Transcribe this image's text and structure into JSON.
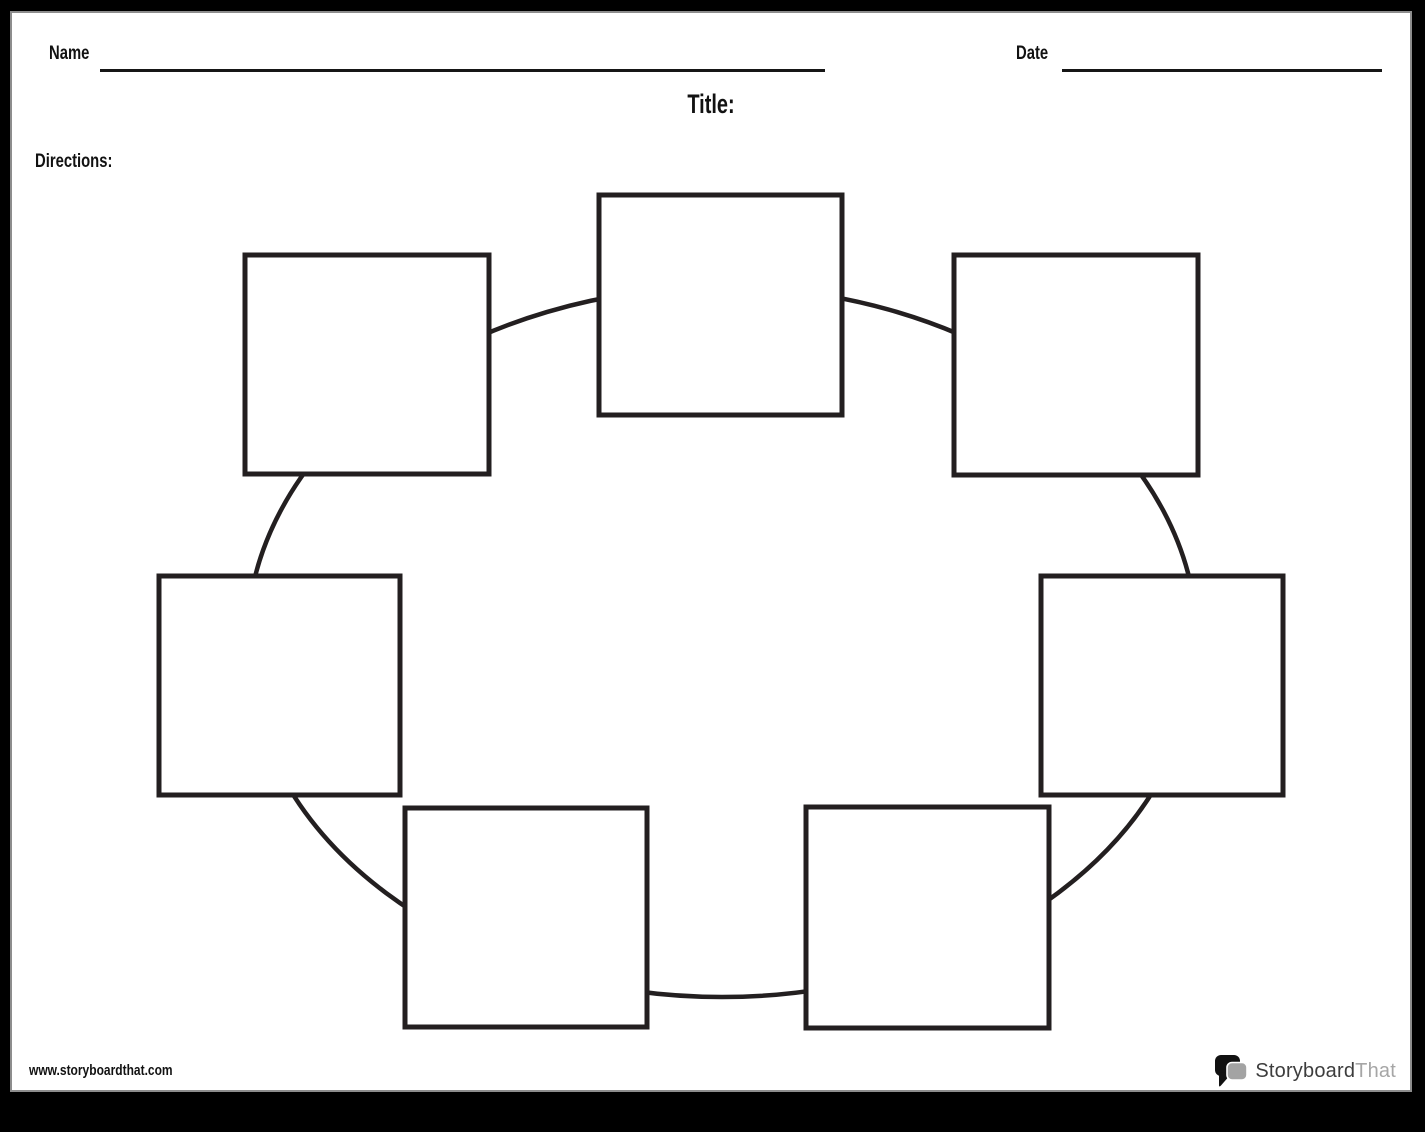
{
  "page": {
    "background": "#ffffff",
    "canvas_background": "#000000",
    "edge_color": "#8d8d8d"
  },
  "header": {
    "name_label": "Name",
    "date_label": "Date",
    "title_label": "Title:",
    "directions_label": "Directions:"
  },
  "footer": {
    "website": "www.storyboardthat.com",
    "logo": {
      "brand_primary": "Storyboard",
      "brand_secondary": "That",
      "primary_color": "#3d3d3d",
      "secondary_color": "#a6a6a6",
      "icon": "speech-bubbles-icon",
      "icon_black": "#111111",
      "icon_gray": "#a3a3a3"
    }
  },
  "diagram": {
    "type": "circle-chart",
    "cell_count": 7,
    "cells_empty": true,
    "stroke_color": "#231f20",
    "fill_color": "#ffffff",
    "ellipse": {
      "cx": 710,
      "cy": 629,
      "rx": 475,
      "ry": 355,
      "stroke_width": 4.5
    },
    "cell_stroke_width": 5,
    "cells": [
      {
        "id": "top",
        "x": 587,
        "y": 182,
        "w": 243,
        "h": 220
      },
      {
        "id": "top-right",
        "x": 942,
        "y": 242,
        "w": 244,
        "h": 220
      },
      {
        "id": "right",
        "x": 1029,
        "y": 563,
        "w": 242,
        "h": 219
      },
      {
        "id": "bottom-right",
        "x": 794,
        "y": 794,
        "w": 243,
        "h": 221
      },
      {
        "id": "bottom-left",
        "x": 393,
        "y": 795,
        "w": 242,
        "h": 219
      },
      {
        "id": "left",
        "x": 147,
        "y": 563,
        "w": 241,
        "h": 219
      },
      {
        "id": "top-left",
        "x": 233,
        "y": 242,
        "w": 244,
        "h": 219
      }
    ]
  }
}
